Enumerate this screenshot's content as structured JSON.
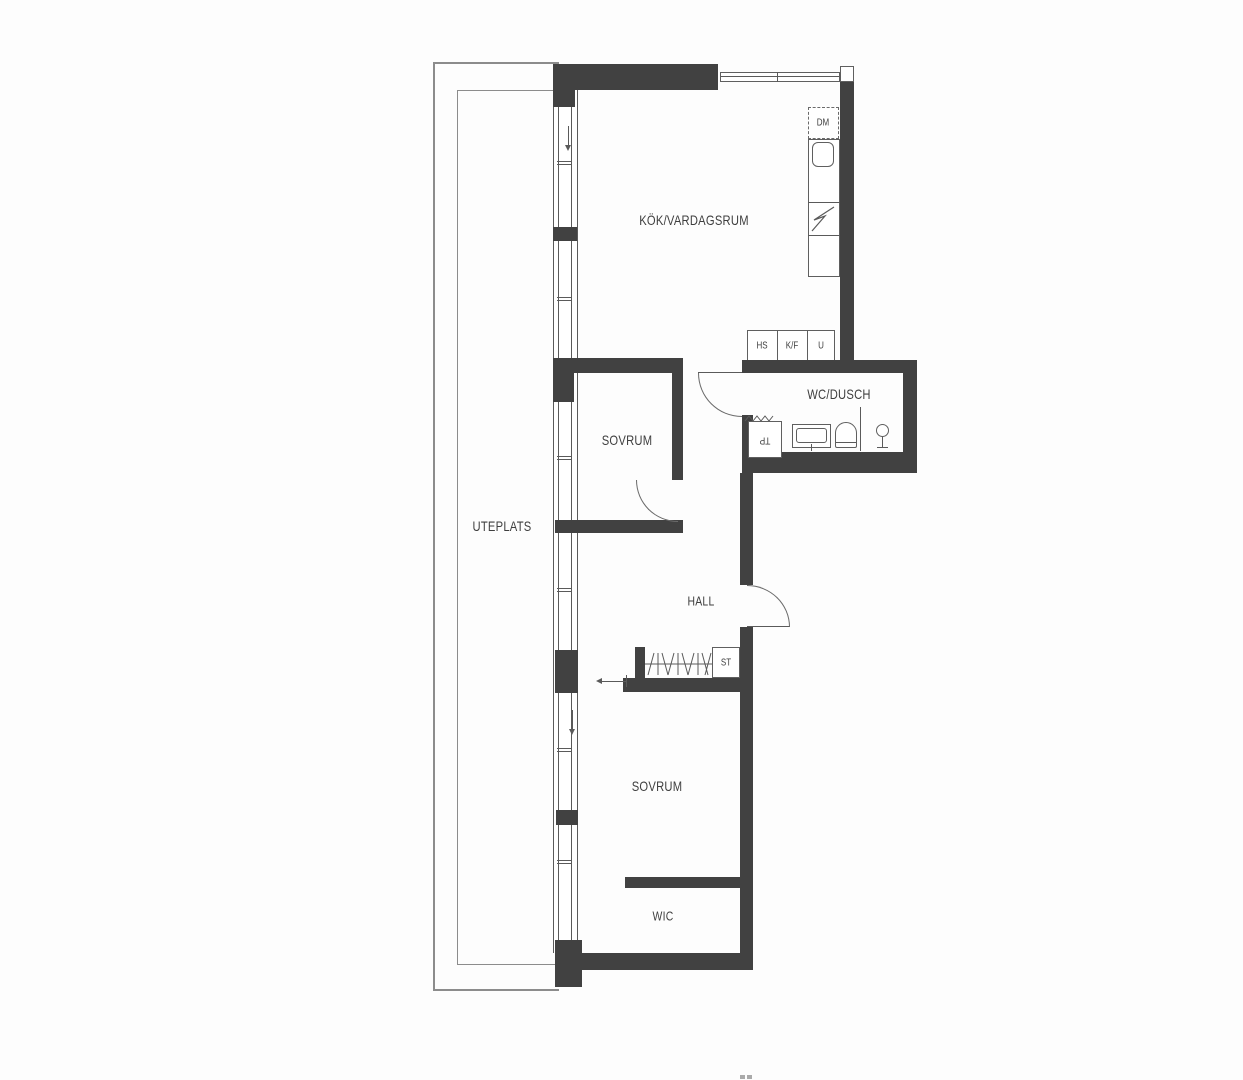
{
  "rooms": {
    "kitchen_living": "KÖK/VARDAGSRUM",
    "bedroom_upper": "SOVRUM",
    "bedroom_lower": "SOVRUM",
    "wc_shower": "WC/DUSCH",
    "hall": "HALL",
    "patio": "UTEPLATS",
    "walk_in_closet": "WIC"
  },
  "appliances": {
    "dishwasher": "DM",
    "tall_cabinet": "HS",
    "fridge_freezer": "K/F",
    "oven": "U",
    "cleaning_cabinet": "ST",
    "laundry_tower": "TP"
  },
  "colors": {
    "wall": "#414141",
    "line": "#5a5a5a",
    "patio_line": "#8c8c8c",
    "text": "#3e3e3e",
    "background": "#fdfdfd"
  }
}
